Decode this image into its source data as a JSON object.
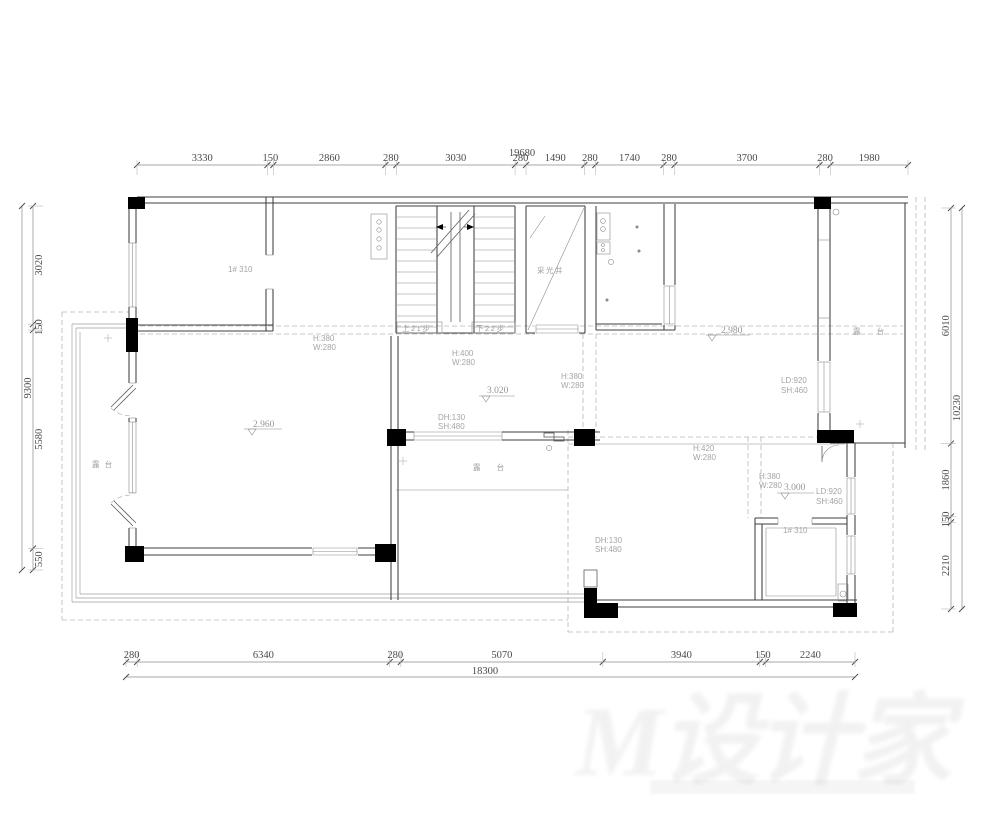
{
  "title": "residential floor plan — structural / beam layout with dimensions (mm)",
  "dims": {
    "top": {
      "total": 19680,
      "segments": [
        3330,
        150,
        2860,
        280,
        3030,
        280,
        1490,
        280,
        1740,
        280,
        3700,
        280,
        1980
      ]
    },
    "bottom": {
      "total": 18300,
      "segments": [
        280,
        6340,
        280,
        5070,
        3940,
        150,
        2240
      ]
    },
    "left": {
      "total": 9300,
      "segments": [
        3020,
        150,
        5580,
        550
      ]
    },
    "right": {
      "total": 10230,
      "segments": [
        6010,
        1860,
        150,
        2210
      ]
    }
  },
  "levels": {
    "living": "2.960",
    "center": "3.020",
    "terrace_tr": "2.980",
    "room_lr": "3.000"
  },
  "ann": {
    "room_a": "1# 310",
    "small_room": "1# 310",
    "stair_up": "上21步",
    "stair_down": "下22步",
    "light_well": "采光井",
    "terrace_left": "露 台",
    "terrace_center": "露 台",
    "terrace_right": "露 台",
    "beam_a_h": "H:380",
    "beam_a_w": "W:280",
    "beam_stair_h": "H:400",
    "beam_stair_w": "W:280",
    "beam_mid_h": "H:380",
    "beam_mid_w": "W:280",
    "beam_lr1_h": "H:420",
    "beam_lr1_w": "W:280",
    "beam_lr2_h": "H:380",
    "beam_lr2_w": "W:280",
    "win_tr_l1": "LD:920",
    "win_tr_l2": "SH:460",
    "win_lr_l1": "LD:920",
    "win_lr_l2": "SH:460",
    "sill_c_l1": "DH:130",
    "sill_c_l2": "SH:480",
    "sill_lr_l1": "DH:130",
    "sill_lr_l2": "SH:480"
  },
  "watermark": "M设计家"
}
